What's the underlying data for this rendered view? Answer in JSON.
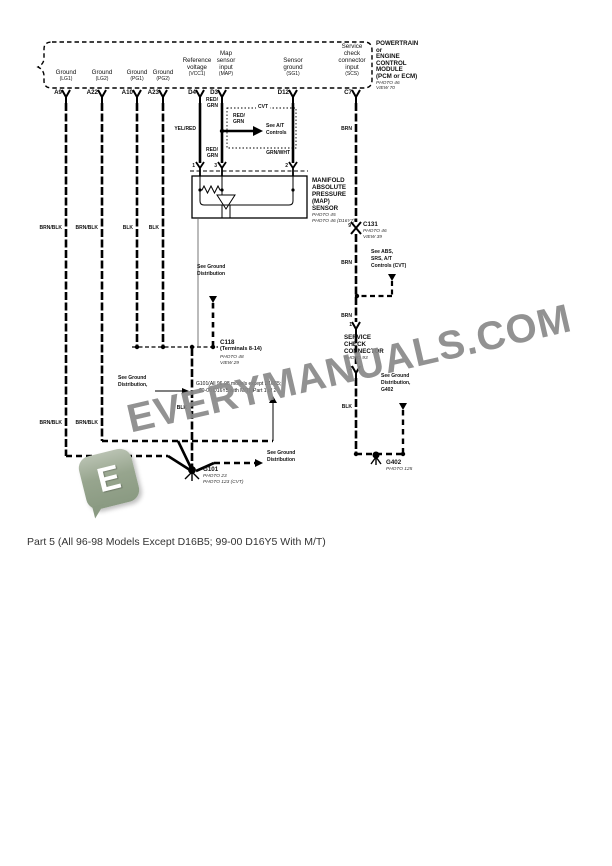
{
  "caption": {
    "text": "Part 5 (All 96-98 Models Except D16B5; 99-00 D16Y5 With M/T)"
  },
  "watermark": {
    "text": "EVERYMANUALS.COM",
    "logo_letter": "E",
    "text_color": "#8a8a8a",
    "logo_color": "#8a9a82"
  },
  "module": {
    "title_lines": [
      "POWERTRAIN",
      "or",
      "ENGINE",
      "CONTROL",
      "MODULE",
      "(PCM or ECM)"
    ],
    "photo": "PHOTO 46",
    "view": "VIEW 70"
  },
  "pins": [
    {
      "id": "A9",
      "signal": "Ground",
      "code": "(LG1)",
      "wire_color": "BRN/BLK"
    },
    {
      "id": "A22",
      "signal": "Ground",
      "code": "(LG2)",
      "wire_color": "BRN/BLK"
    },
    {
      "id": "A10",
      "signal": "Ground",
      "code": "(PG1)",
      "wire_color": "BLK"
    },
    {
      "id": "A23",
      "signal": "Ground",
      "code": "(PG2)",
      "wire_color": "BLK"
    },
    {
      "id": "D4",
      "signal": "Reference voltage",
      "code": "(VCC1)",
      "wire_color": "YEL/RED"
    },
    {
      "id": "D3",
      "signal": "Map sensor input",
      "code": "(MAP)",
      "wire_color": "RED/GRN"
    },
    {
      "id": "D12",
      "signal": "Sensor ground",
      "code": "(SG1)",
      "wire_color": "GRN/WHT"
    },
    {
      "id": "C7",
      "signal": "Service check connector input",
      "code": "(SCS)",
      "wire_color": "BRN"
    }
  ],
  "components": {
    "map_sensor": {
      "label_lines": [
        "MANIFOLD",
        "ABSOLUTE",
        "PRESSURE",
        "(MAP)",
        "SENSOR"
      ],
      "refs": [
        "PHOTO 45",
        "PHOTO 46 (D16Y7)"
      ],
      "terminals": [
        "1",
        "3",
        "2"
      ]
    },
    "cvt_box": {
      "title": "CVT",
      "wire": "RED/ GRN",
      "note": "See A/T Controls"
    },
    "c131": {
      "id": "C131",
      "pin": "9",
      "refs": [
        "PHOTO 46",
        "VIEW 39"
      ]
    },
    "abs_note": {
      "lines": [
        "See ABS,",
        "SRS, A/T",
        "Controls (CVT)"
      ]
    },
    "service_check": {
      "pins": [
        "1",
        "2"
      ],
      "label_lines": [
        "SERVICE",
        "CHECK",
        "CONNECTOR"
      ],
      "ref": "PHOTO 93"
    },
    "c118": {
      "id": "C118",
      "sub": "(Terminals 8-14)",
      "refs": [
        "PHOTO 48",
        "VIEW 29"
      ]
    },
    "g402": {
      "id": "G402",
      "ref": "PHOTO 125",
      "note_lines": [
        "See Ground",
        "Distribution,",
        "G402"
      ]
    },
    "g101": {
      "id": "G101",
      "refs": [
        "PHOTO 23",
        "PHOTO 123 (CVT)"
      ],
      "note_lines": [
        "G101(All 96-98 models except D16B5;",
        "99-00 D16Y5 with M/T), Part 1 of 2"
      ]
    },
    "ground_distribution_note": "See Ground Distribution"
  },
  "labels": [
    {
      "n": "signal-a9-1",
      "t": "Ground",
      "x": 66,
      "y": 70,
      "c": "ca s6"
    },
    {
      "n": "signal-a9-2",
      "t": "(LG1)",
      "x": 66,
      "y": 77,
      "c": "ca s5"
    },
    {
      "n": "signal-a22-1",
      "t": "Ground",
      "x": 102,
      "y": 70,
      "c": "ca s6"
    },
    {
      "n": "signal-a22-2",
      "t": "(LG2)",
      "x": 102,
      "y": 77,
      "c": "ca s5"
    },
    {
      "n": "signal-a10-1",
      "t": "Ground",
      "x": 137,
      "y": 70,
      "c": "ca s6"
    },
    {
      "n": "signal-a10-2",
      "t": "(PG1)",
      "x": 137,
      "y": 77,
      "c": "ca s5"
    },
    {
      "n": "signal-a23-1",
      "t": "Ground",
      "x": 163,
      "y": 70,
      "c": "ca s6"
    },
    {
      "n": "signal-a23-2",
      "t": "(PG2)",
      "x": 163,
      "y": 77,
      "c": "ca s5"
    },
    {
      "n": "signal-d4-1",
      "t": "Reference",
      "x": 197,
      "y": 58,
      "c": "ca s6"
    },
    {
      "n": "signal-d4-2",
      "t": "voltage",
      "x": 197,
      "y": 65,
      "c": "ca s6"
    },
    {
      "n": "signal-d4-3",
      "t": "(VCC1)",
      "x": 197,
      "y": 72,
      "c": "ca s5"
    },
    {
      "n": "signal-d3-1",
      "t": "Map",
      "x": 226,
      "y": 51,
      "c": "ca s6"
    },
    {
      "n": "signal-d3-2",
      "t": "sensor",
      "x": 226,
      "y": 58,
      "c": "ca s6"
    },
    {
      "n": "signal-d3-3",
      "t": "input",
      "x": 226,
      "y": 65,
      "c": "ca s6"
    },
    {
      "n": "signal-d3-4",
      "t": "(MAP)",
      "x": 226,
      "y": 72,
      "c": "ca s5"
    },
    {
      "n": "signal-d12-1",
      "t": "Sensor",
      "x": 293,
      "y": 58,
      "c": "ca s6"
    },
    {
      "n": "signal-d12-2",
      "t": "ground",
      "x": 293,
      "y": 65,
      "c": "ca s6"
    },
    {
      "n": "signal-d12-3",
      "t": "(SG1)",
      "x": 293,
      "y": 72,
      "c": "ca s5"
    },
    {
      "n": "signal-c7-1",
      "t": "Service",
      "x": 352,
      "y": 44,
      "c": "ca s6"
    },
    {
      "n": "signal-c7-2",
      "t": "check",
      "x": 352,
      "y": 51,
      "c": "ca s6"
    },
    {
      "n": "signal-c7-3",
      "t": "connector",
      "x": 352,
      "y": 58,
      "c": "ca s6"
    },
    {
      "n": "signal-c7-4",
      "t": "input",
      "x": 352,
      "y": 65,
      "c": "ca s6"
    },
    {
      "n": "signal-c7-5",
      "t": "(SCS)",
      "x": 352,
      "y": 72,
      "c": "ca s5"
    },
    {
      "n": "pin-label-a9",
      "t": "A9",
      "x": 62,
      "y": 90,
      "c": "ra b s6"
    },
    {
      "n": "pin-label-a22",
      "t": "A22",
      "x": 98,
      "y": 90,
      "c": "ra b s6"
    },
    {
      "n": "pin-label-a10",
      "t": "A10",
      "x": 133,
      "y": 90,
      "c": "ra b s6"
    },
    {
      "n": "pin-label-a23",
      "t": "A23",
      "x": 159,
      "y": 90,
      "c": "ra b s6"
    },
    {
      "n": "pin-label-d4",
      "t": "D4",
      "x": 196,
      "y": 90,
      "c": "ra b s6"
    },
    {
      "n": "pin-label-d3",
      "t": "D3",
      "x": 218,
      "y": 90,
      "c": "ra b s6"
    },
    {
      "n": "pin-label-d12",
      "t": "D12",
      "x": 289,
      "y": 90,
      "c": "ra b s6"
    },
    {
      "n": "pin-label-c7",
      "t": "C7",
      "x": 352,
      "y": 90,
      "c": "ra b s6"
    },
    {
      "n": "pcm-title-1",
      "t": "POWERTRAIN",
      "x": 376,
      "y": 41,
      "c": "b s6"
    },
    {
      "n": "pcm-title-2",
      "t": "or",
      "x": 376,
      "y": 47.5,
      "c": "b s6"
    },
    {
      "n": "pcm-title-3",
      "t": "ENGINE",
      "x": 376,
      "y": 54,
      "c": "b s6"
    },
    {
      "n": "pcm-title-4",
      "t": "CONTROL",
      "x": 376,
      "y": 60.5,
      "c": "b s6"
    },
    {
      "n": "pcm-title-5",
      "t": "MODULE",
      "x": 376,
      "y": 67,
      "c": "b s6"
    },
    {
      "n": "pcm-title-6",
      "t": "(PCM or ECM)",
      "x": 376,
      "y": 73.5,
      "c": "b s6"
    },
    {
      "n": "pcm-ref-photo",
      "t": "PHOTO 46",
      "x": 376,
      "y": 80.5,
      "c": "i"
    },
    {
      "n": "pcm-ref-view",
      "t": "VIEW 70",
      "x": 376,
      "y": 86,
      "c": "i"
    },
    {
      "n": "wire-color-a9",
      "t": "BRN/BLK",
      "x": 62,
      "y": 226,
      "c": "ra b s5"
    },
    {
      "n": "wire-color-a22",
      "t": "BRN/BLK",
      "x": 98,
      "y": 226,
      "c": "ra b s5"
    },
    {
      "n": "wire-color-a10",
      "t": "BLK",
      "x": 133,
      "y": 226,
      "c": "ra b s5"
    },
    {
      "n": "wire-color-a23",
      "t": "BLK",
      "x": 159,
      "y": 226,
      "c": "ra b s5"
    },
    {
      "n": "wire-color-d4",
      "t": "YEL/RED",
      "x": 196,
      "y": 127,
      "c": "ra b s5"
    },
    {
      "n": "wire-color-d3-1a",
      "t": "RED/",
      "x": 218,
      "y": 98,
      "c": "ra b s5"
    },
    {
      "n": "wire-color-d3-1b",
      "t": "GRN",
      "x": 218,
      "y": 104,
      "c": "ra b s5"
    },
    {
      "n": "wire-color-d3-2a",
      "t": "RED/",
      "x": 218,
      "y": 148,
      "c": "ra b s5"
    },
    {
      "n": "wire-color-d3-2b",
      "t": "GRN",
      "x": 218,
      "y": 154,
      "c": "ra b s5"
    },
    {
      "n": "cvt-wire-color-a",
      "t": "RED/",
      "x": 233,
      "y": 114,
      "c": "b s5"
    },
    {
      "n": "cvt-wire-color-b",
      "t": "GRN",
      "x": 233,
      "y": 120,
      "c": "b s5"
    },
    {
      "n": "cvt-note-1",
      "t": "See A/T",
      "x": 266,
      "y": 124,
      "c": "b s5"
    },
    {
      "n": "cvt-note-2",
      "t": "Controls",
      "x": 266,
      "y": 131,
      "c": "b s5"
    },
    {
      "n": "wire-color-d12",
      "t": "GRN/WHT",
      "x": 290,
      "y": 151,
      "c": "ra b s5"
    },
    {
      "n": "map-terminal-1",
      "t": "1",
      "x": 195,
      "y": 164,
      "c": "ra b s5"
    },
    {
      "n": "map-terminal-3",
      "t": "3",
      "x": 217,
      "y": 164,
      "c": "ra b s5"
    },
    {
      "n": "map-terminal-2",
      "t": "2",
      "x": 288,
      "y": 164,
      "c": "ra b s5"
    },
    {
      "n": "map-label-1",
      "t": "MANIFOLD",
      "x": 312,
      "y": 178,
      "c": "b s6"
    },
    {
      "n": "map-label-2",
      "t": "ABSOLUTE",
      "x": 312,
      "y": 185,
      "c": "b s6"
    },
    {
      "n": "map-label-3",
      "t": "PRESSURE",
      "x": 312,
      "y": 192,
      "c": "b s6"
    },
    {
      "n": "map-label-4",
      "t": "(MAP)",
      "x": 312,
      "y": 199,
      "c": "b s6"
    },
    {
      "n": "map-label-5",
      "t": "SENSOR",
      "x": 312,
      "y": 206,
      "c": "b s6"
    },
    {
      "n": "map-ref-1",
      "t": "PHOTO 45",
      "x": 312,
      "y": 213,
      "c": "i"
    },
    {
      "n": "map-ref-2",
      "t": "PHOTO 46 (D16Y7)",
      "x": 312,
      "y": 219,
      "c": "i"
    },
    {
      "n": "wire-color-c7-1",
      "t": "BRN",
      "x": 352,
      "y": 127,
      "c": "ra b s5"
    },
    {
      "n": "c131-pin-9",
      "t": "9",
      "x": 351,
      "y": 224,
      "c": "ra b s5"
    },
    {
      "n": "c131-id",
      "t": "C131",
      "x": 363,
      "y": 222,
      "c": "b s6"
    },
    {
      "n": "c131-ref-1",
      "t": "PHOTO 46",
      "x": 363,
      "y": 229,
      "c": "i"
    },
    {
      "n": "c131-ref-2",
      "t": "VIEW 39",
      "x": 363,
      "y": 235,
      "c": "i"
    },
    {
      "n": "abs-note-1",
      "t": "See ABS,",
      "x": 371,
      "y": 250,
      "c": "b s5"
    },
    {
      "n": "abs-note-2",
      "t": "SRS, A/T",
      "x": 371,
      "y": 257,
      "c": "b s5"
    },
    {
      "n": "abs-note-3",
      "t": "Controls (CVT)",
      "x": 371,
      "y": 264,
      "c": "b s5"
    },
    {
      "n": "wire-color-c7-2",
      "t": "BRN",
      "x": 352,
      "y": 261,
      "c": "ra b s5"
    },
    {
      "n": "wire-color-c7-3",
      "t": "BRN",
      "x": 352,
      "y": 314,
      "c": "ra b s5"
    },
    {
      "n": "scc-pin-1",
      "t": "1",
      "x": 352,
      "y": 323,
      "c": "ra b s5"
    },
    {
      "n": "scc-label-1",
      "t": "SERVICE",
      "x": 344,
      "y": 335,
      "c": "b s6"
    },
    {
      "n": "scc-label-2",
      "t": "CHECK",
      "x": 344,
      "y": 342,
      "c": "b s6"
    },
    {
      "n": "scc-label-3",
      "t": "CONNECTOR",
      "x": 344,
      "y": 349,
      "c": "b s6"
    },
    {
      "n": "scc-ref",
      "t": "PHOTO 93",
      "x": 344,
      "y": 356,
      "c": "i"
    },
    {
      "n": "scc-pin-2",
      "t": "2",
      "x": 352,
      "y": 367,
      "c": "ra b s5"
    },
    {
      "n": "gd-top-note-1",
      "t": "See Ground",
      "x": 197,
      "y": 265,
      "c": "b s5"
    },
    {
      "n": "gd-top-note-2",
      "t": "Distribution",
      "x": 197,
      "y": 272,
      "c": "b s5"
    },
    {
      "n": "c118-id",
      "t": "C118",
      "x": 220,
      "y": 340,
      "c": "b s6"
    },
    {
      "n": "c118-sub",
      "t": "(Terminals 8-14)",
      "x": 220,
      "y": 347,
      "c": "b s55"
    },
    {
      "n": "c118-ref-1",
      "t": "PHOTO 48",
      "x": 220,
      "y": 355,
      "c": "i"
    },
    {
      "n": "c118-ref-2",
      "t": "VIEW 29",
      "x": 220,
      "y": 361,
      "c": "i"
    },
    {
      "n": "gd-left-note-1",
      "t": "See Ground",
      "x": 118,
      "y": 376,
      "c": "b s5"
    },
    {
      "n": "gd-left-note-2",
      "t": "Distribution,",
      "x": 118,
      "y": 383,
      "c": "b s5"
    },
    {
      "n": "g101-note-1",
      "t": "G101(All 96-98 models except D16B5;",
      "x": 196,
      "y": 382,
      "c": "s5"
    },
    {
      "n": "g101-note-2",
      "t": "99-00 D16Y5 with M/T), Part 1 of 2",
      "x": 199,
      "y": 389,
      "c": "s5"
    },
    {
      "n": "g402-note-1",
      "t": "See Ground",
      "x": 381,
      "y": 374,
      "c": "b s5"
    },
    {
      "n": "g402-note-2",
      "t": "Distribution,",
      "x": 381,
      "y": 381,
      "c": "b s5"
    },
    {
      "n": "g402-note-3",
      "t": "G402",
      "x": 381,
      "y": 388,
      "c": "b s5"
    },
    {
      "n": "wire-color-c7-4",
      "t": "BLK",
      "x": 352,
      "y": 405,
      "c": "ra b s5"
    },
    {
      "n": "wire-color-a9-low",
      "t": "BRN/BLK",
      "x": 62,
      "y": 421,
      "c": "ra b s5"
    },
    {
      "n": "wire-color-a22-low",
      "t": "BRN/BLK",
      "x": 98,
      "y": 421,
      "c": "ra b s5"
    },
    {
      "n": "wire-color-main-blk",
      "t": "BLK",
      "x": 187,
      "y": 406,
      "c": "ra b s5"
    },
    {
      "n": "gd-right-note-1",
      "t": "See Ground",
      "x": 267,
      "y": 451,
      "c": "b s5"
    },
    {
      "n": "gd-right-note-2",
      "t": "Distribution",
      "x": 267,
      "y": 458,
      "c": "b s5"
    },
    {
      "n": "g101-id",
      "t": "G101",
      "x": 203,
      "y": 467,
      "c": "b s6"
    },
    {
      "n": "g101-ref-1",
      "t": "PHOTO 23",
      "x": 203,
      "y": 474,
      "c": "i"
    },
    {
      "n": "g101-ref-2",
      "t": "PHOTO 123 (CVT)",
      "x": 203,
      "y": 480,
      "c": "i"
    },
    {
      "n": "g402-id",
      "t": "G402",
      "x": 386,
      "y": 460,
      "c": "b s6"
    },
    {
      "n": "g402-ref",
      "t": "PHOTO 125",
      "x": 386,
      "y": 467,
      "c": "i"
    }
  ]
}
